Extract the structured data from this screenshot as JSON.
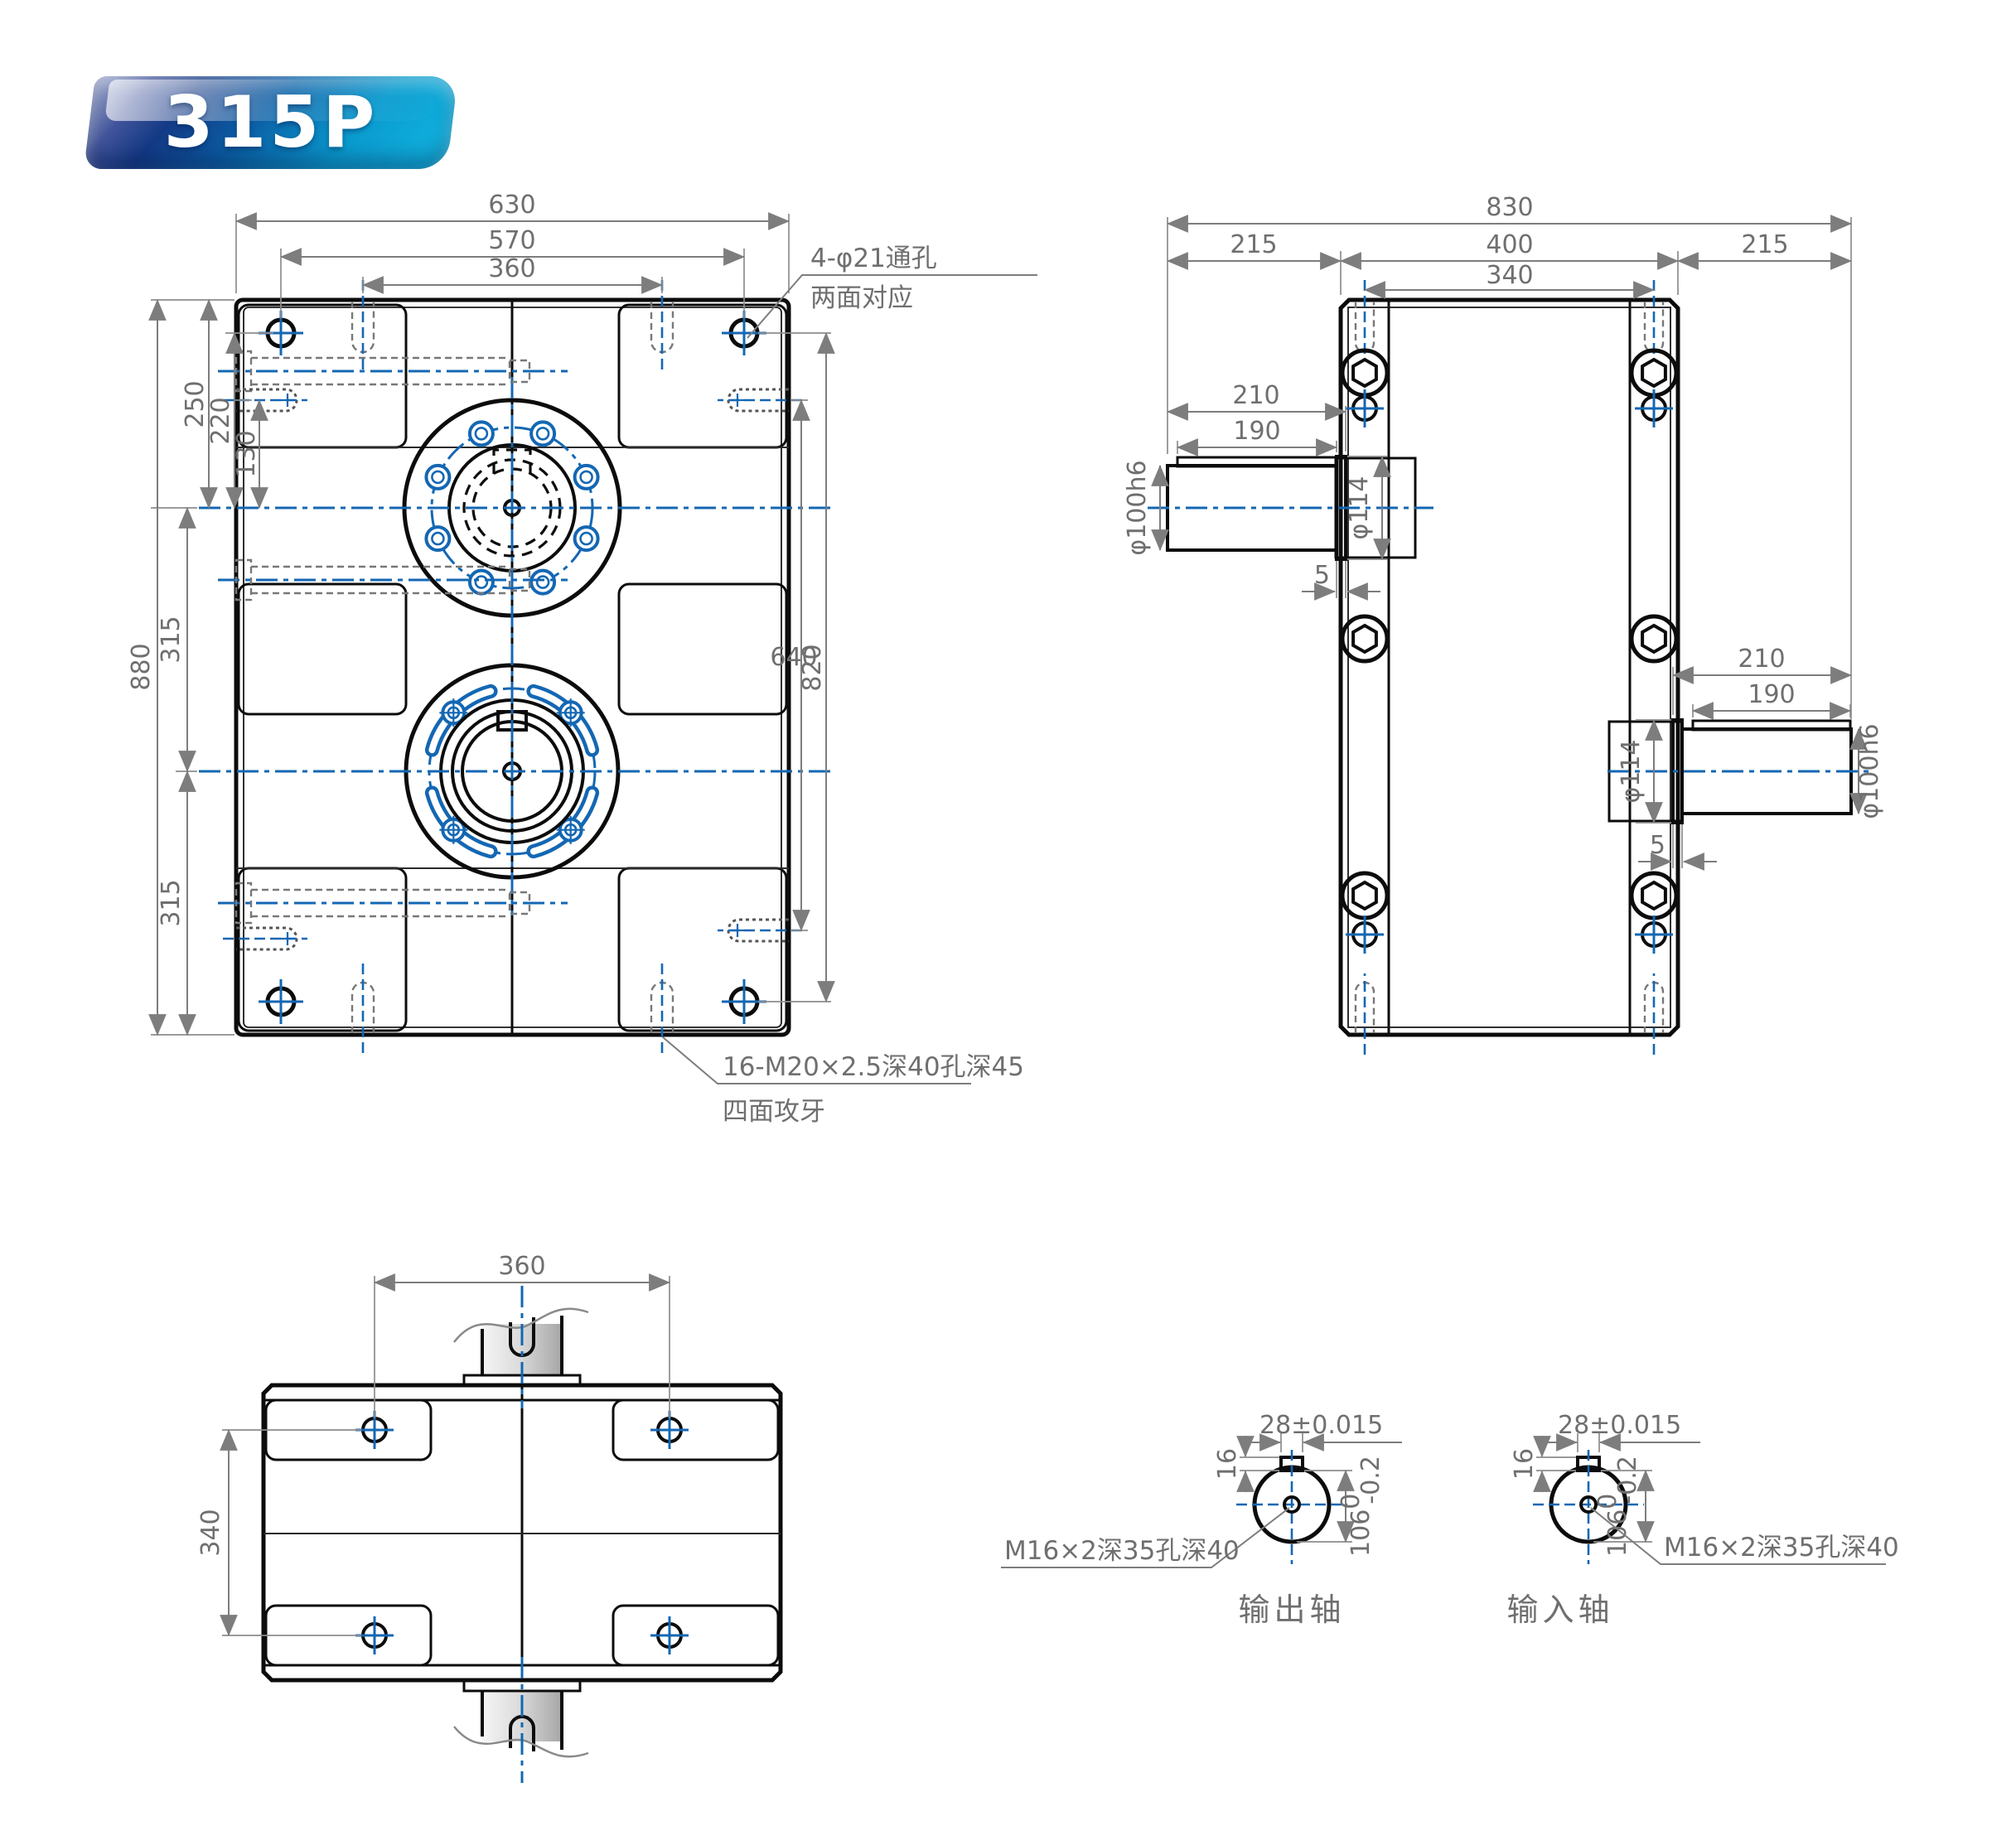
{
  "badge": {
    "model": "315P"
  },
  "front_view": {
    "dim_width_total": "630",
    "dim_width_holes": "570",
    "dim_width_slots": "360",
    "dim_height_total": "880",
    "dim_upper_shaft_offset": "250",
    "dim_corner_hole_offset": "220",
    "dim_side_hole_offset": "130",
    "dim_shaft_spacing": "315",
    "dim_bottom_offset": "315",
    "dim_right_inner": "640",
    "dim_right_outer": "820",
    "note_through_holes_1": "4-φ21通孔",
    "note_through_holes_2": "两面对应",
    "note_tapped_1": "16-M20×2.5深40孔深45",
    "note_tapped_2": "四面攻牙"
  },
  "side_view": {
    "dim_width_total": "830",
    "dim_left_margin": "215",
    "dim_center_width": "400",
    "dim_right_margin": "215",
    "dim_drill_span": "340",
    "input_shaft": {
      "dim_length": "210",
      "dim_key_length": "190",
      "dim_shaft_dia": "φ100h6",
      "dim_boss_dia": "φ114",
      "dim_step": "5"
    },
    "output_shaft": {
      "dim_length": "210",
      "dim_key_length": "190",
      "dim_shaft_dia": "φ100h6",
      "dim_boss_dia": "φ114",
      "dim_step": "5"
    }
  },
  "bottom_view": {
    "dim_slot_span": "360",
    "dim_hole_span": "340"
  },
  "shaft_sections": {
    "output": {
      "title": "输出轴",
      "dim_key_width": "28±0.015",
      "dim_key_depth": "16",
      "dim_dia_main": "106",
      "dim_dia_sup": "0",
      "dim_dia_sub": "-0.2",
      "note_tap": "M16×2深35孔深40"
    },
    "input": {
      "title": "输入轴",
      "dim_key_width": "28±0.015",
      "dim_key_depth": "16",
      "dim_dia_main": "106",
      "dim_dia_sup": "0",
      "dim_dia_sub": "-0.2",
      "note_tap": "M16×2深35孔深40"
    }
  }
}
